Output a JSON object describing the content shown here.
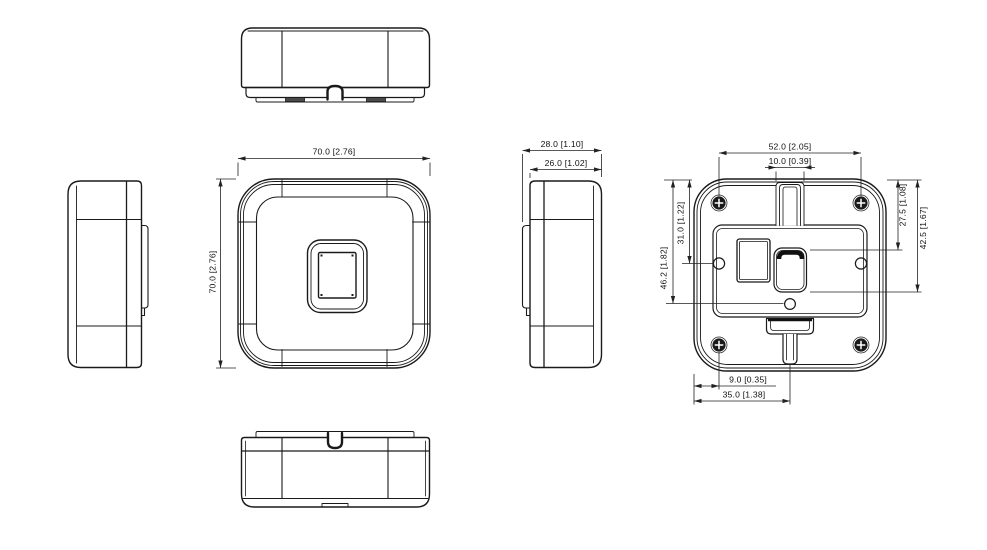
{
  "drawing": {
    "background": "#ffffff",
    "line_color": "#1a1a1a",
    "dim_color": "#222222",
    "dimensions": {
      "front_width": "70.0 [2.76]",
      "front_height": "70.0 [2.76]",
      "side_overall_depth": "28.0 [1.10]",
      "side_body_depth": "26.0 [1.02]",
      "back_screw_span": "52.0 [2.05]",
      "back_channel_width": "10.0 [0.39]",
      "back_pin_offset": "46.2 [1.82]",
      "back_hole_offset": "31.0 [1.22]",
      "back_slot_top_offset": "27.5 [1.08]",
      "back_slot_bottom_offset": "42.5 [1.67]",
      "back_screw_edge_offset": "9.0 [0.35]",
      "back_center_edge_offset": "35.0 [1.38]"
    }
  }
}
